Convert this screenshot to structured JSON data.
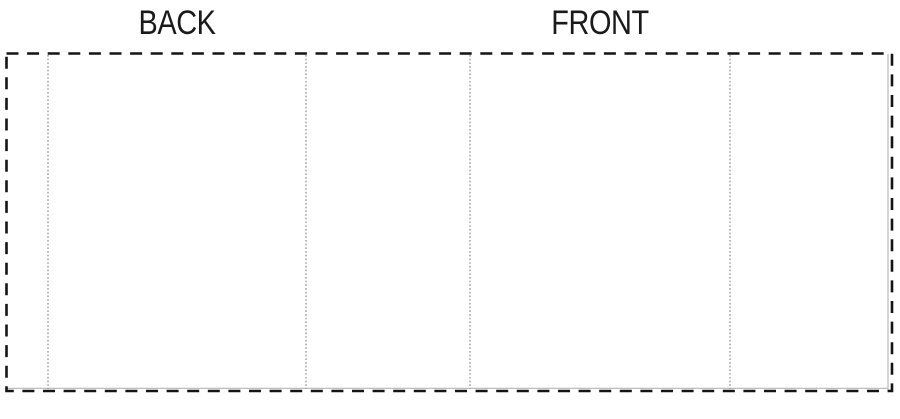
{
  "diagram": {
    "back_label": "BACK",
    "front_label": "FRONT",
    "colors": {
      "cut_line": "#141414",
      "fold_line": "#9a9a9a",
      "edge_line": "#b5b5b5",
      "label_text": "#1a1a1a",
      "background": "#ffffff"
    }
  }
}
